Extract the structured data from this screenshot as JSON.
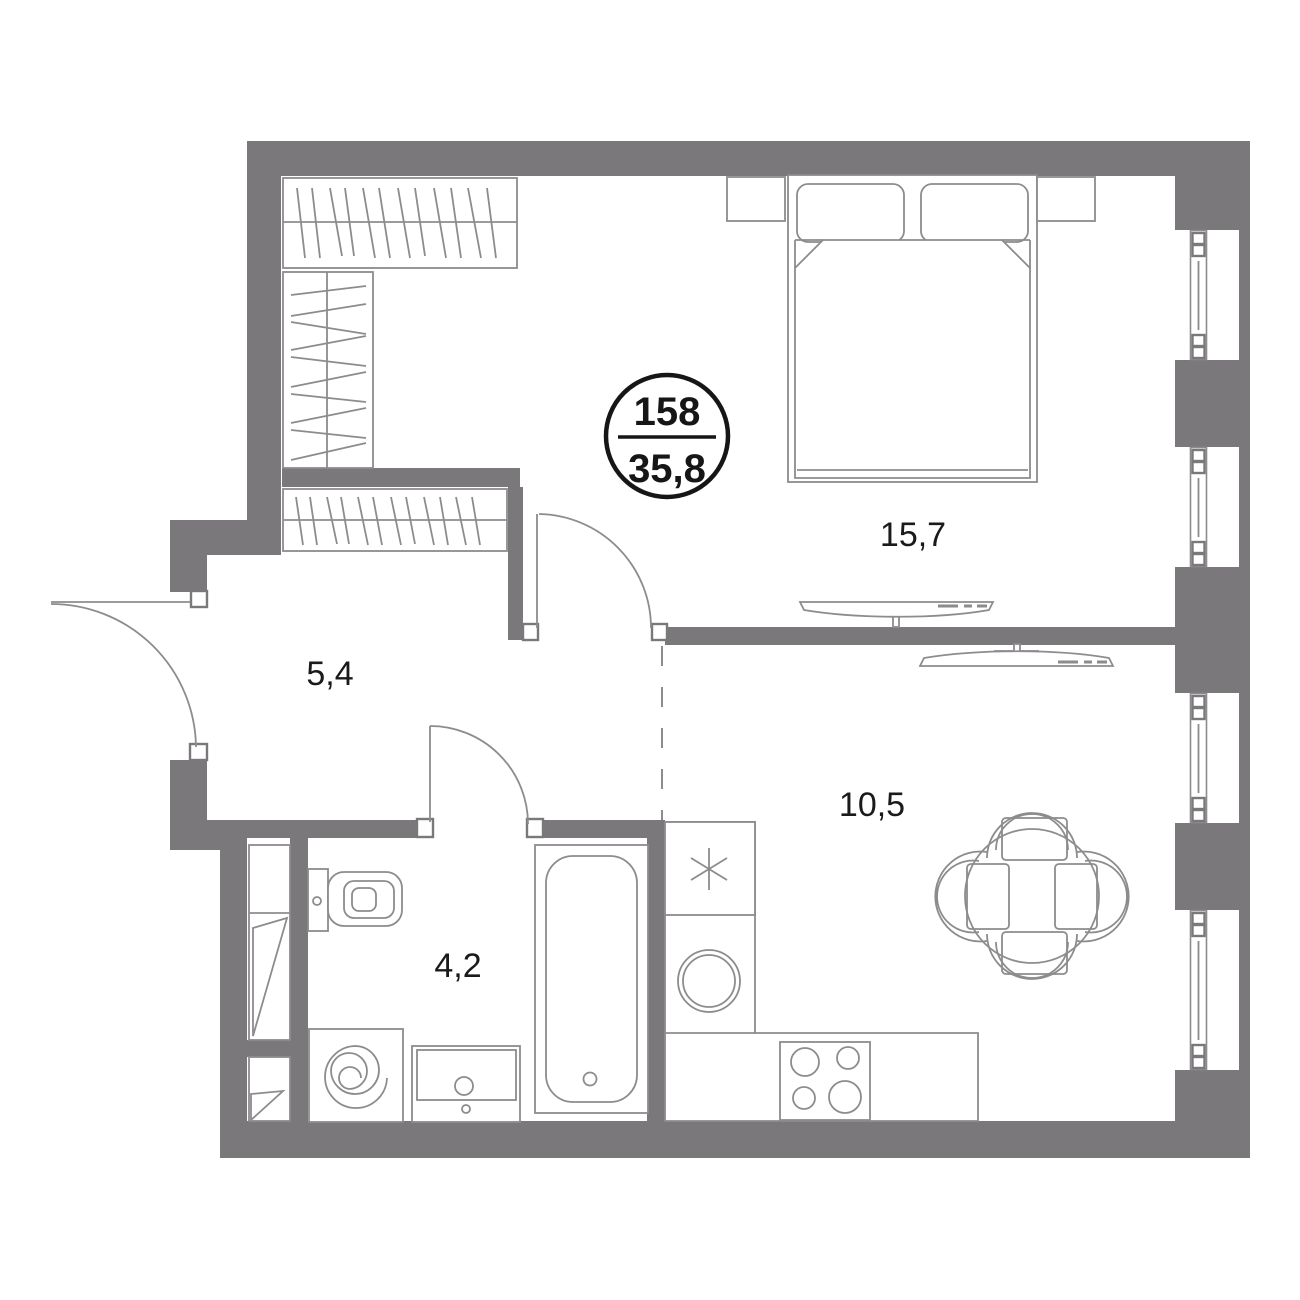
{
  "plan": {
    "unit_number": "158",
    "total_area": "35,8",
    "rooms": [
      {
        "id": "bedroom",
        "area_label": "15,7"
      },
      {
        "id": "hallway",
        "area_label": "5,4"
      },
      {
        "id": "kitchen-living",
        "area_label": "10,5"
      },
      {
        "id": "bathroom",
        "area_label": "4,2"
      }
    ],
    "colors": {
      "wall": "#7a787b",
      "line": "#8d8b8e",
      "text": "#1a1a1a",
      "bg": "#ffffff",
      "ink": "#161616"
    }
  }
}
